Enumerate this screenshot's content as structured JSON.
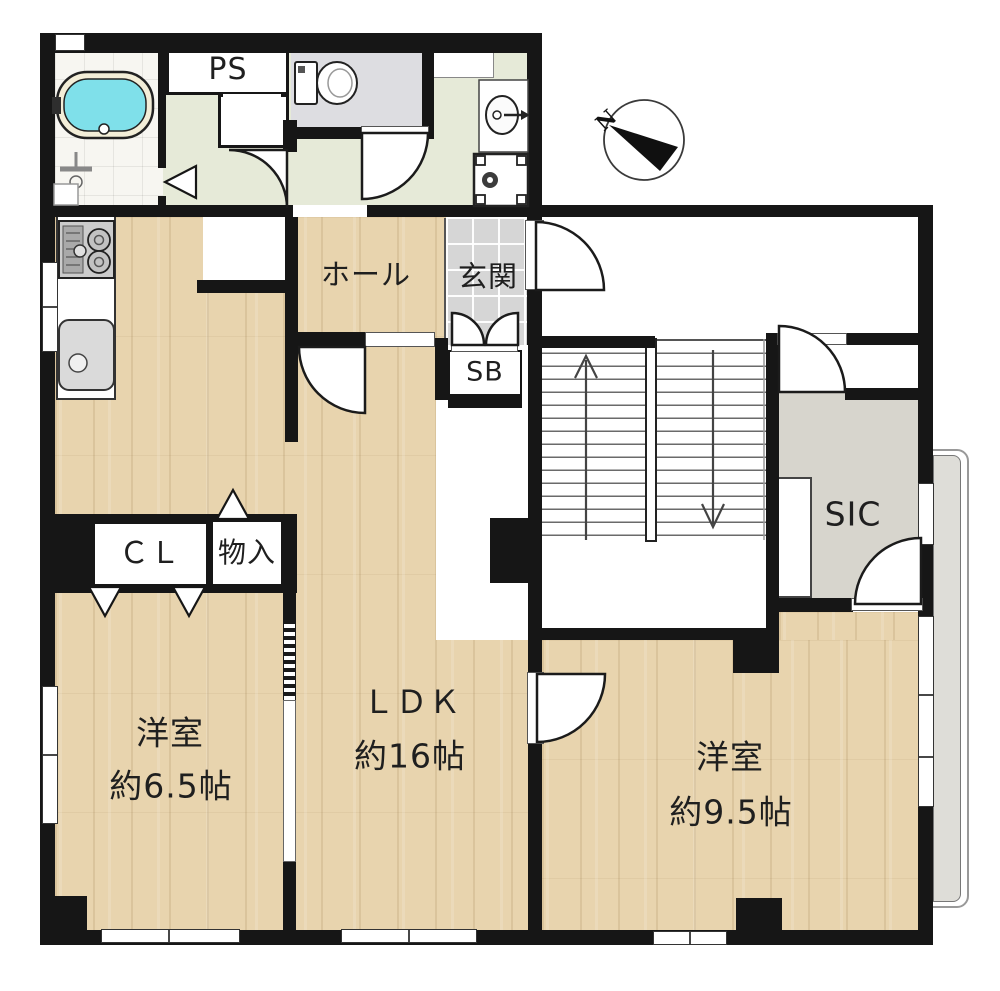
{
  "plan_title": "floor-plan",
  "labels": {
    "ps": "PS",
    "hall": "ホール",
    "entrance": "玄関",
    "shoe_box": "SB",
    "shoe_in_closet": "SIC",
    "closet": "ＣＬ",
    "storage": "物入",
    "bedroom_left_name": "洋室",
    "bedroom_left_size": "約6.5帖",
    "ldk_name": "ＬＤＫ",
    "ldk_size": "約16帖",
    "bedroom_right_name": "洋室",
    "bedroom_right_size": "約9.5帖",
    "compass_north": "N"
  },
  "colors": {
    "wall": "#161616",
    "wood_floor": "#e8d4ae",
    "entrance_tile": "#d6d6d6",
    "washroom_floor": "#e6ead8",
    "toilet_floor": "#dddde1",
    "sic_floor": "#d7d5cd",
    "balcony": "#deddd8",
    "bathtub_water": "#7fe0ea"
  }
}
